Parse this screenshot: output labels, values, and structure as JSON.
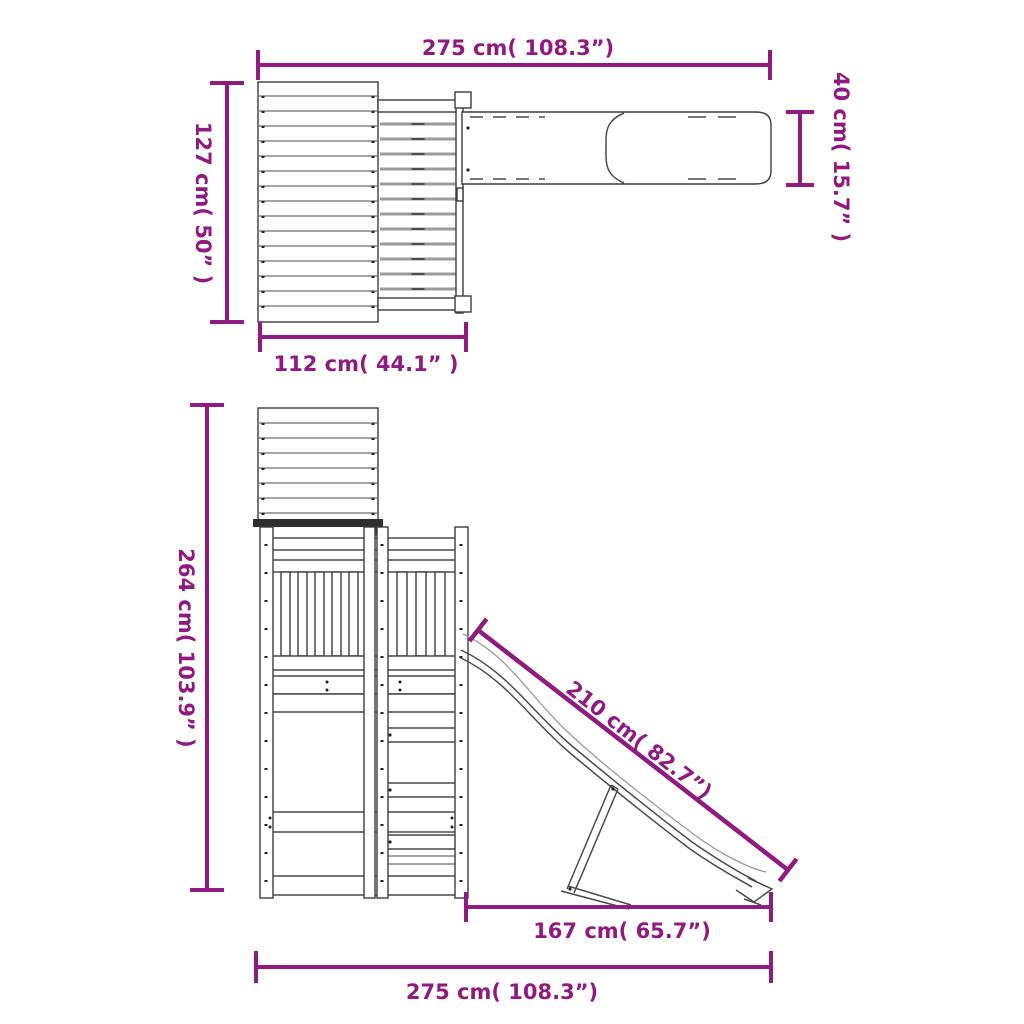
{
  "colors": {
    "dimension_accent": "#8F1B80",
    "drawing_line": "#3C3C3C"
  },
  "top_view": {
    "overall_width": "275 cm( 108.3”)",
    "depth": "127 cm( 50” )",
    "slide_width": "40 cm( 15.7” )",
    "house_depth": "112 cm( 44.1” )"
  },
  "side_view": {
    "height": "264 cm( 103.9” )",
    "slide_length": "210 cm( 82.7”)",
    "slide_run": "167 cm( 65.7”)",
    "overall_width": "275 cm( 108.3”)"
  }
}
